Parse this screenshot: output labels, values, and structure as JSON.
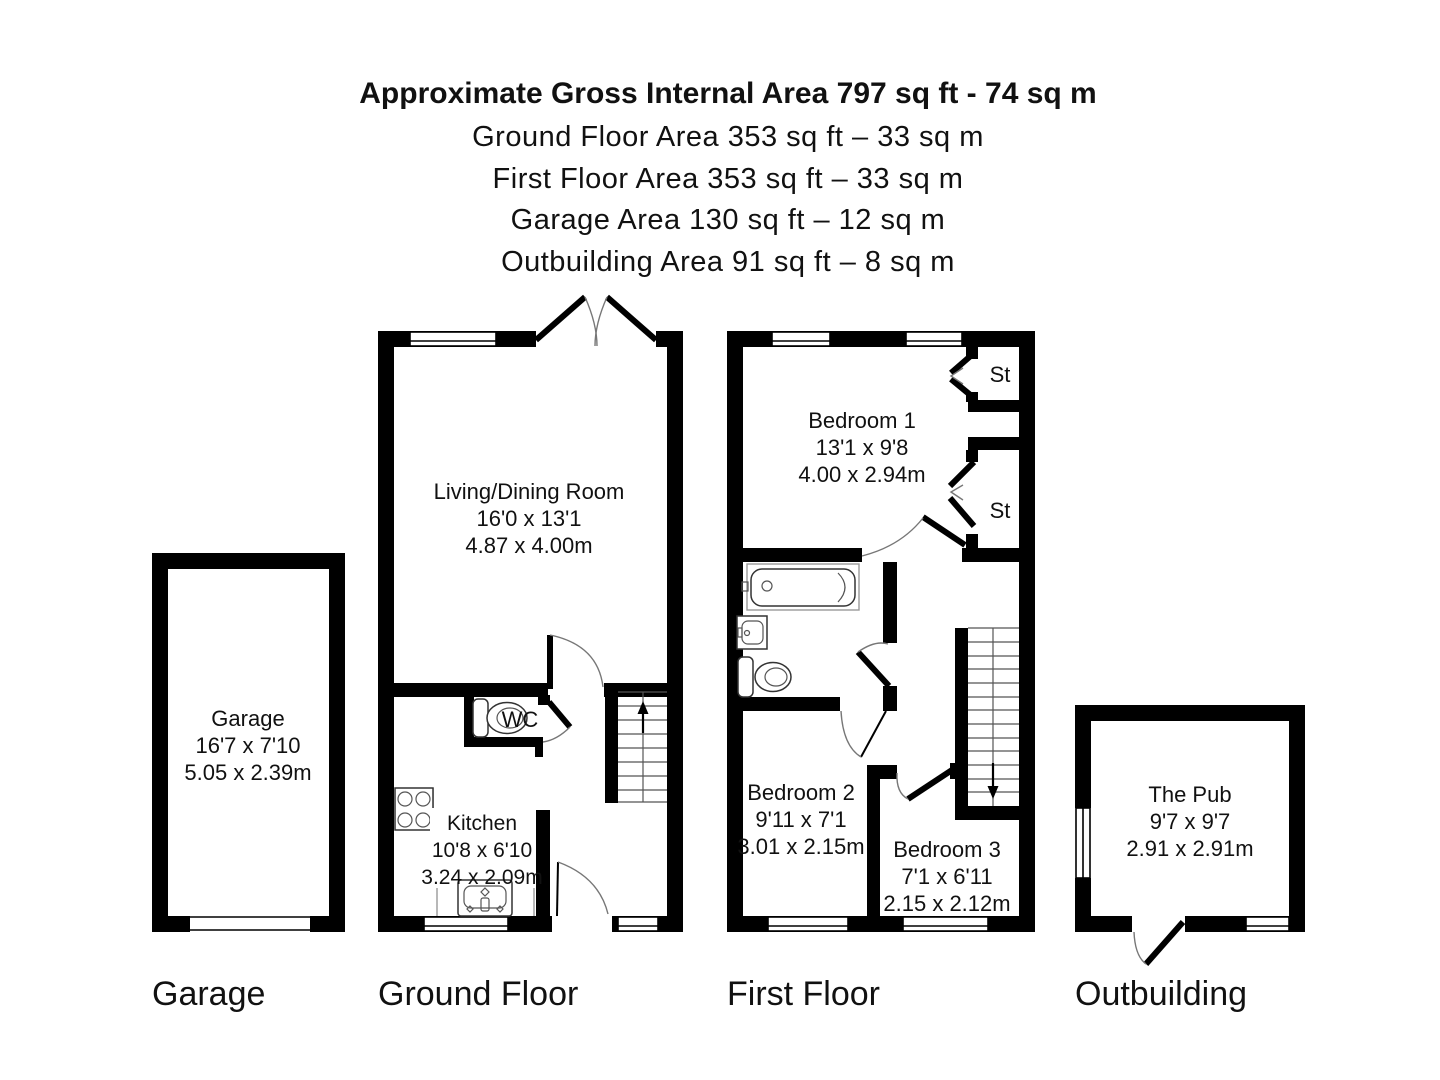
{
  "header": {
    "title": "Approximate Gross Internal Area 797 sq ft - 74 sq m",
    "lines": [
      "Ground Floor Area 353 sq ft – 33 sq m",
      "First Floor Area 353 sq ft – 33 sq m",
      "Garage Area 130 sq ft – 12 sq m",
      "Outbuilding Area 91 sq ft – 8 sq m"
    ]
  },
  "sections": {
    "garage": {
      "label": "Garage",
      "rooms": [
        {
          "name": "Garage",
          "dims_ft": "16'7 x 7'10",
          "dims_m": "5.05 x 2.39m"
        }
      ]
    },
    "ground_floor": {
      "label": "Ground Floor",
      "rooms": [
        {
          "name": "Living/Dining Room",
          "dims_ft": "16'0 x 13'1",
          "dims_m": "4.87 x 4.00m"
        },
        {
          "name": "Kitchen",
          "dims_ft": "10'8 x 6'10",
          "dims_m": "3.24 x 2.09m"
        },
        {
          "name": "WC"
        }
      ]
    },
    "first_floor": {
      "label": "First Floor",
      "rooms": [
        {
          "name": "Bedroom 1",
          "dims_ft": "13'1 x 9'8",
          "dims_m": "4.00 x 2.94m"
        },
        {
          "name": "Bedroom 2",
          "dims_ft": "9'11 x 7'1",
          "dims_m": "3.01 x 2.15m"
        },
        {
          "name": "Bedroom 3",
          "dims_ft": "7'1 x 6'11",
          "dims_m": "2.15 x 2.12m"
        },
        {
          "name": "St"
        },
        {
          "name": "St"
        }
      ]
    },
    "outbuilding": {
      "label": "Outbuilding",
      "rooms": [
        {
          "name": "The Pub",
          "dims_ft": "9'7 x 9'7",
          "dims_m": "2.91 x 2.91m"
        }
      ]
    }
  },
  "colors": {
    "wall": "#000000",
    "background": "#ffffff",
    "door_arc": "#777777"
  }
}
